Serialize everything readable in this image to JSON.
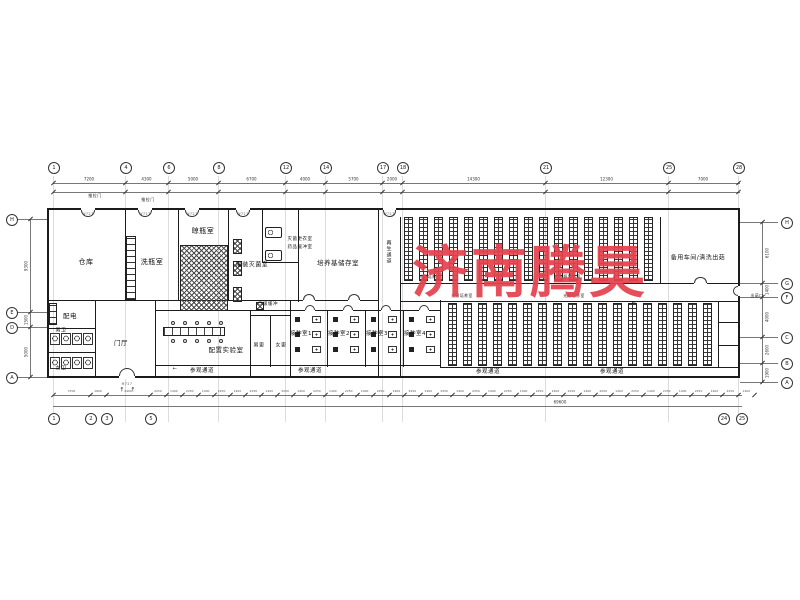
{
  "watermark": {
    "text": "济南腾昊",
    "color": "#e5424e"
  },
  "colors": {
    "wall": "#1c1c1c",
    "dimension": "#777777",
    "grid": "#8a8a8a",
    "watermark_red": "#e5424e"
  },
  "plan": {
    "grid_vertical_xs": [
      53,
      125,
      168,
      218,
      285,
      325,
      382,
      402,
      545,
      668,
      738
    ],
    "bubbles": {
      "top": {
        "y": 167,
        "items": [
          {
            "x": 53,
            "label": "1"
          },
          {
            "x": 125,
            "label": "4"
          },
          {
            "x": 168,
            "label": "6"
          },
          {
            "x": 218,
            "label": "8"
          },
          {
            "x": 285,
            "label": "12"
          },
          {
            "x": 325,
            "label": "14"
          },
          {
            "x": 382,
            "label": "17"
          },
          {
            "x": 402,
            "label": "18"
          },
          {
            "x": 545,
            "label": "21"
          },
          {
            "x": 668,
            "label": "25"
          },
          {
            "x": 738,
            "label": "28"
          }
        ]
      },
      "bottom": {
        "y": 418,
        "items": [
          {
            "x": 53,
            "label": "1"
          },
          {
            "x": 90,
            "label": "2"
          },
          {
            "x": 106,
            "label": "3"
          },
          {
            "x": 150,
            "label": "5"
          },
          {
            "x": 723,
            "label": "24"
          },
          {
            "x": 741,
            "label": "25"
          }
        ]
      },
      "left": {
        "x": 6,
        "items": [
          {
            "y": 219,
            "label": "H"
          },
          {
            "y": 312,
            "label": "E"
          },
          {
            "y": 327,
            "label": "D"
          },
          {
            "y": 377,
            "label": "A"
          }
        ]
      },
      "right": {
        "x": 781,
        "items": [
          {
            "y": 222,
            "label": "H"
          },
          {
            "y": 283,
            "label": "G"
          },
          {
            "y": 297,
            "label": "F"
          },
          {
            "y": 337,
            "label": "C"
          },
          {
            "y": 363,
            "label": "B"
          },
          {
            "y": 382,
            "label": "A"
          }
        ]
      }
    },
    "dims": {
      "top": {
        "line_y": 183,
        "line2_y": 192,
        "num_y": 179,
        "xs": [
          53,
          125,
          168,
          218,
          285,
          325,
          382,
          402,
          545,
          668,
          738
        ],
        "values": [
          "7200",
          "4300",
          "5000",
          "6700",
          "4000",
          "5700",
          "2000",
          "14300",
          "12300",
          "7000"
        ]
      },
      "bottom": {
        "line_y": 395,
        "line2_y": 406,
        "num_y": 391,
        "left_xs": [
          53,
          90,
          106,
          150
        ],
        "left_values": [
          "3700",
          "1600",
          "4400"
        ],
        "gen": {
          "x0": 150,
          "step": 15.9,
          "count": 38,
          "alt_values": [
            "2250",
            "1400"
          ]
        },
        "overall": {
          "text": "69600",
          "x": 560,
          "y": 402
        }
      },
      "left": {
        "line_x": 30,
        "ys": [
          219,
          312,
          327,
          377
        ],
        "values": [
          "9300",
          "1500",
          "5000"
        ]
      },
      "right": {
        "line_x": 762,
        "ys": [
          222,
          283,
          297,
          337,
          363,
          382
        ],
        "values": [
          "6100",
          "1400",
          "4000",
          "2600",
          "1900"
        ]
      }
    },
    "walls": [
      {
        "x": 47,
        "y": 208,
        "w": 693,
        "h": 2
      },
      {
        "x": 47,
        "y": 376,
        "w": 693,
        "h": 2
      },
      {
        "x": 47,
        "y": 208,
        "w": 2,
        "h": 170
      },
      {
        "x": 738,
        "y": 208,
        "w": 2,
        "h": 170
      },
      {
        "x": 125,
        "y": 210,
        "w": 1,
        "h": 90
      },
      {
        "x": 178,
        "y": 210,
        "w": 1,
        "h": 90
      },
      {
        "x": 228,
        "y": 210,
        "w": 1,
        "h": 90
      },
      {
        "x": 262,
        "y": 210,
        "w": 1,
        "h": 52
      },
      {
        "x": 298,
        "y": 210,
        "w": 1,
        "h": 92
      },
      {
        "x": 378,
        "y": 210,
        "w": 1,
        "h": 168
      },
      {
        "x": 400,
        "y": 217,
        "w": 1,
        "h": 161
      },
      {
        "x": 660,
        "y": 217,
        "w": 1,
        "h": 66
      },
      {
        "x": 95,
        "y": 300,
        "w": 1,
        "h": 78
      },
      {
        "x": 155,
        "y": 300,
        "w": 1,
        "h": 78
      },
      {
        "x": 250,
        "y": 310,
        "w": 1,
        "h": 68
      },
      {
        "x": 270,
        "y": 315,
        "w": 1,
        "h": 52
      },
      {
        "x": 290,
        "y": 300,
        "w": 1,
        "h": 78
      },
      {
        "x": 327,
        "y": 310,
        "w": 1,
        "h": 57
      },
      {
        "x": 365,
        "y": 310,
        "w": 1,
        "h": 57
      },
      {
        "x": 403,
        "y": 310,
        "w": 1,
        "h": 57
      },
      {
        "x": 440,
        "y": 300,
        "w": 1,
        "h": 67
      },
      {
        "x": 718,
        "y": 302,
        "w": 1,
        "h": 65
      },
      {
        "x": 47,
        "y": 300,
        "w": 331,
        "h": 1
      },
      {
        "x": 262,
        "y": 262,
        "w": 37,
        "h": 1
      },
      {
        "x": 155,
        "y": 310,
        "w": 285,
        "h": 1
      },
      {
        "x": 47,
        "y": 328,
        "w": 48,
        "h": 1
      },
      {
        "x": 47,
        "y": 352,
        "w": 48,
        "h": 1
      },
      {
        "x": 155,
        "y": 365,
        "w": 285,
        "h": 1
      },
      {
        "x": 250,
        "y": 315,
        "w": 40,
        "h": 1
      },
      {
        "x": 400,
        "y": 283,
        "w": 338,
        "h": 1
      },
      {
        "x": 400,
        "y": 301,
        "w": 338,
        "h": 1
      },
      {
        "x": 440,
        "y": 367,
        "w": 298,
        "h": 1
      },
      {
        "x": 718,
        "y": 322,
        "w": 20,
        "h": 1
      },
      {
        "x": 718,
        "y": 345,
        "w": 20,
        "h": 1
      }
    ],
    "dim_lines": [
      {
        "x": 53,
        "y": 183,
        "w": 687,
        "h": 1
      },
      {
        "x": 53,
        "y": 192,
        "w": 687,
        "h": 1
      },
      {
        "x": 53,
        "y": 395,
        "w": 689,
        "h": 1
      },
      {
        "x": 53,
        "y": 406,
        "w": 689,
        "h": 1
      },
      {
        "x": 30,
        "y": 219,
        "w": 1,
        "h": 158
      },
      {
        "x": 762,
        "y": 222,
        "w": 1,
        "h": 160
      },
      {
        "x": 16,
        "y": 219,
        "w": 31,
        "h": 1
      },
      {
        "x": 16,
        "y": 312,
        "w": 31,
        "h": 1
      },
      {
        "x": 16,
        "y": 327,
        "w": 31,
        "h": 1
      },
      {
        "x": 16,
        "y": 377,
        "w": 31,
        "h": 1
      },
      {
        "x": 740,
        "y": 222,
        "w": 38,
        "h": 1
      },
      {
        "x": 740,
        "y": 283,
        "w": 38,
        "h": 1
      },
      {
        "x": 740,
        "y": 297,
        "w": 38,
        "h": 1
      },
      {
        "x": 740,
        "y": 337,
        "w": 38,
        "h": 1
      },
      {
        "x": 740,
        "y": 363,
        "w": 38,
        "h": 1
      },
      {
        "x": 740,
        "y": 382,
        "w": 38,
        "h": 1
      }
    ],
    "rack_bands": [
      {
        "x0": 404,
        "step": 15,
        "count": 17,
        "w": 9,
        "y": 217,
        "h": 64
      },
      {
        "x0": 448,
        "step": 15,
        "count": 18,
        "w": 9,
        "y": 303,
        "h": 63
      }
    ],
    "doors": [
      {
        "x": 81,
        "y": 208,
        "w": 14,
        "dir": "D"
      },
      {
        "x": 138,
        "y": 208,
        "w": 14,
        "dir": "D"
      },
      {
        "x": 185,
        "y": 208,
        "w": 14,
        "dir": "D"
      },
      {
        "x": 236,
        "y": 208,
        "w": 14,
        "dir": "D"
      },
      {
        "x": 383,
        "y": 208,
        "w": 13,
        "dir": "D"
      },
      {
        "x": 694,
        "y": 283,
        "w": 13,
        "dir": "U"
      },
      {
        "x": 303,
        "y": 300,
        "w": 12,
        "dir": "U"
      },
      {
        "x": 348,
        "y": 300,
        "w": 12,
        "dir": "U"
      },
      {
        "x": 305,
        "y": 310,
        "w": 10,
        "dir": "U"
      },
      {
        "x": 343,
        "y": 310,
        "w": 10,
        "dir": "U"
      },
      {
        "x": 381,
        "y": 310,
        "w": 10,
        "dir": "U"
      },
      {
        "x": 419,
        "y": 310,
        "w": 10,
        "dir": "U"
      },
      {
        "x": 119,
        "y": 376,
        "w": 16,
        "dir": "U"
      },
      {
        "x": 738,
        "y": 286,
        "w": 10,
        "dir": "L"
      }
    ],
    "equipment": [
      {
        "type": "ladder",
        "x": 126,
        "y": 236,
        "w": 10,
        "h": 64
      },
      {
        "type": "ladder",
        "x": 49,
        "y": 303,
        "w": 8,
        "h": 22
      },
      {
        "type": "xhatch",
        "x": 180,
        "y": 245,
        "w": 48,
        "h": 66
      },
      {
        "type": "xhatch",
        "x": 233,
        "y": 239,
        "w": 9,
        "h": 15
      },
      {
        "type": "xhatch",
        "x": 233,
        "y": 261,
        "w": 9,
        "h": 15
      },
      {
        "type": "xhatch",
        "x": 233,
        "y": 287,
        "w": 9,
        "h": 15
      },
      {
        "type": "xhatch",
        "x": 256,
        "y": 302,
        "w": 8,
        "h": 8
      },
      {
        "type": "machine",
        "x": 265,
        "y": 227,
        "w": 17,
        "h": 11
      },
      {
        "type": "machine",
        "x": 265,
        "y": 250,
        "w": 17,
        "h": 11
      },
      {
        "type": "bench",
        "x": 163,
        "y": 327,
        "w": 62,
        "h": 9
      },
      {
        "type": "circ",
        "x": 171,
        "y": 321,
        "w": 4,
        "h": 4
      },
      {
        "type": "circ",
        "x": 183,
        "y": 321,
        "w": 4,
        "h": 4
      },
      {
        "type": "circ",
        "x": 195,
        "y": 321,
        "w": 4,
        "h": 4
      },
      {
        "type": "circ",
        "x": 207,
        "y": 321,
        "w": 4,
        "h": 4
      },
      {
        "type": "circ",
        "x": 219,
        "y": 321,
        "w": 4,
        "h": 4
      },
      {
        "type": "circ",
        "x": 171,
        "y": 339,
        "w": 4,
        "h": 4
      },
      {
        "type": "circ",
        "x": 183,
        "y": 339,
        "w": 4,
        "h": 4
      },
      {
        "type": "circ",
        "x": 195,
        "y": 339,
        "w": 4,
        "h": 4
      },
      {
        "type": "circ",
        "x": 207,
        "y": 339,
        "w": 4,
        "h": 4
      },
      {
        "type": "circ",
        "x": 219,
        "y": 339,
        "w": 4,
        "h": 4
      },
      {
        "type": "stall",
        "x": 50,
        "y": 333,
        "w": 10,
        "h": 12
      },
      {
        "type": "stall",
        "x": 61,
        "y": 333,
        "w": 10,
        "h": 12
      },
      {
        "type": "stall",
        "x": 72,
        "y": 333,
        "w": 10,
        "h": 12
      },
      {
        "type": "stall",
        "x": 83,
        "y": 333,
        "w": 10,
        "h": 12
      },
      {
        "type": "stall",
        "x": 50,
        "y": 357,
        "w": 10,
        "h": 12
      },
      {
        "type": "stall",
        "x": 61,
        "y": 357,
        "w": 10,
        "h": 12
      },
      {
        "type": "stall",
        "x": 72,
        "y": 357,
        "w": 10,
        "h": 12
      },
      {
        "type": "stall",
        "x": 83,
        "y": 357,
        "w": 10,
        "h": 12
      },
      {
        "type": "sq",
        "x": 295,
        "y": 317,
        "w": 5,
        "h": 5
      },
      {
        "type": "sq",
        "x": 295,
        "y": 332,
        "w": 5,
        "h": 5
      },
      {
        "type": "sq",
        "x": 295,
        "y": 347,
        "w": 5,
        "h": 5
      },
      {
        "type": "hood",
        "x": 312,
        "y": 316,
        "w": 9,
        "h": 7
      },
      {
        "type": "hood",
        "x": 312,
        "y": 331,
        "w": 9,
        "h": 7
      },
      {
        "type": "hood",
        "x": 312,
        "y": 346,
        "w": 9,
        "h": 7
      },
      {
        "type": "sq",
        "x": 333,
        "y": 317,
        "w": 5,
        "h": 5
      },
      {
        "type": "sq",
        "x": 333,
        "y": 332,
        "w": 5,
        "h": 5
      },
      {
        "type": "sq",
        "x": 333,
        "y": 347,
        "w": 5,
        "h": 5
      },
      {
        "type": "hood",
        "x": 350,
        "y": 316,
        "w": 9,
        "h": 7
      },
      {
        "type": "hood",
        "x": 350,
        "y": 331,
        "w": 9,
        "h": 7
      },
      {
        "type": "hood",
        "x": 350,
        "y": 346,
        "w": 9,
        "h": 7
      },
      {
        "type": "sq",
        "x": 371,
        "y": 317,
        "w": 5,
        "h": 5
      },
      {
        "type": "sq",
        "x": 371,
        "y": 332,
        "w": 5,
        "h": 5
      },
      {
        "type": "sq",
        "x": 371,
        "y": 347,
        "w": 5,
        "h": 5
      },
      {
        "type": "hood",
        "x": 388,
        "y": 316,
        "w": 9,
        "h": 7
      },
      {
        "type": "hood",
        "x": 388,
        "y": 331,
        "w": 9,
        "h": 7
      },
      {
        "type": "hood",
        "x": 388,
        "y": 346,
        "w": 9,
        "h": 7
      },
      {
        "type": "sq",
        "x": 409,
        "y": 317,
        "w": 5,
        "h": 5
      },
      {
        "type": "sq",
        "x": 409,
        "y": 332,
        "w": 5,
        "h": 5
      },
      {
        "type": "sq",
        "x": 409,
        "y": 347,
        "w": 5,
        "h": 5
      },
      {
        "type": "hood",
        "x": 426,
        "y": 316,
        "w": 9,
        "h": 7
      },
      {
        "type": "hood",
        "x": 426,
        "y": 331,
        "w": 9,
        "h": 7
      },
      {
        "type": "hood",
        "x": 426,
        "y": 346,
        "w": 9,
        "h": 7
      }
    ],
    "labels": [
      {
        "t": "仓库",
        "x": 86,
        "y": 262,
        "s": 7
      },
      {
        "t": "洗瓶室",
        "x": 152,
        "y": 262,
        "s": 7
      },
      {
        "t": "晾瓶室",
        "x": 203,
        "y": 231,
        "s": 7
      },
      {
        "t": "灌装灭菌室",
        "x": 252,
        "y": 264,
        "s": 6
      },
      {
        "t": "灭菌更衣室",
        "x": 300,
        "y": 239,
        "s": 4.5
      },
      {
        "t": "药品缓冲室",
        "x": 300,
        "y": 247,
        "s": 4.5
      },
      {
        "t": "培养基储存室",
        "x": 338,
        "y": 262,
        "s": 6.5
      },
      {
        "t": "再生通道",
        "x": 389,
        "y": 252,
        "s": 5,
        "v": true
      },
      {
        "t": "备用车间/清洗出菇",
        "x": 698,
        "y": 257,
        "s": 6
      },
      {
        "t": "光照培养室",
        "x": 430,
        "y": 277,
        "s": 3.8
      },
      {
        "t": "光照培养室",
        "x": 570,
        "y": 277,
        "s": 3.8
      },
      {
        "t": "光照培养室",
        "x": 462,
        "y": 296,
        "s": 3.8
      },
      {
        "t": "光照培养室",
        "x": 574,
        "y": 296,
        "s": 3.8
      },
      {
        "t": "配电",
        "x": 70,
        "y": 315,
        "s": 6.5
      },
      {
        "t": "男卫",
        "x": 61,
        "y": 330,
        "s": 5
      },
      {
        "t": "女卫",
        "x": 61,
        "y": 368,
        "s": 5
      },
      {
        "t": "门厅",
        "x": 121,
        "y": 342,
        "s": 6.5
      },
      {
        "t": "配置实验室",
        "x": 226,
        "y": 349,
        "s": 6.5
      },
      {
        "t": "二级缓冲",
        "x": 268,
        "y": 304,
        "s": 4.5
      },
      {
        "t": "男更",
        "x": 259,
        "y": 345,
        "s": 5
      },
      {
        "t": "女更",
        "x": 281,
        "y": 345,
        "s": 5
      },
      {
        "t": "接种室1",
        "x": 301,
        "y": 333,
        "s": 5.5
      },
      {
        "t": "接种室2",
        "x": 339,
        "y": 333,
        "s": 5.5
      },
      {
        "t": "接种室3",
        "x": 377,
        "y": 333,
        "s": 5.5
      },
      {
        "t": "接种室4",
        "x": 415,
        "y": 333,
        "s": 5.5
      },
      {
        "t": "参观通道",
        "x": 202,
        "y": 370,
        "s": 5.5
      },
      {
        "t": "参观通道",
        "x": 310,
        "y": 370,
        "s": 5.5
      },
      {
        "t": "参观通道",
        "x": 488,
        "y": 371,
        "s": 5.5
      },
      {
        "t": "参观通道",
        "x": 612,
        "y": 371,
        "s": 5.5
      },
      {
        "t": "推拉门",
        "x": 95,
        "y": 196,
        "s": 4
      },
      {
        "t": "推拉门",
        "x": 148,
        "y": 200,
        "s": 4
      },
      {
        "t": "出菇口",
        "x": 757,
        "y": 296,
        "s": 3.8
      },
      {
        "t": "←",
        "x": 175,
        "y": 369,
        "s": 5
      },
      {
        "t": "←",
        "x": 634,
        "y": 303,
        "s": 5
      },
      {
        "t": "↑",
        "x": 122,
        "y": 390,
        "s": 6
      },
      {
        "t": "↑",
        "x": 133,
        "y": 390,
        "s": 6
      },
      {
        "t": "W727",
        "x": 88,
        "y": 214,
        "s": 3.2,
        "c": "#555"
      },
      {
        "t": "W727",
        "x": 145,
        "y": 214,
        "s": 3.2,
        "c": "#555"
      },
      {
        "t": "W727",
        "x": 192,
        "y": 214,
        "s": 3.2,
        "c": "#555"
      },
      {
        "t": "W727",
        "x": 243,
        "y": 214,
        "s": 3.2,
        "c": "#555"
      },
      {
        "t": "W727",
        "x": 389,
        "y": 214,
        "s": 3.2,
        "c": "#555"
      },
      {
        "t": "M727",
        "x": 127,
        "y": 384,
        "s": 3.2,
        "c": "#555"
      }
    ]
  }
}
